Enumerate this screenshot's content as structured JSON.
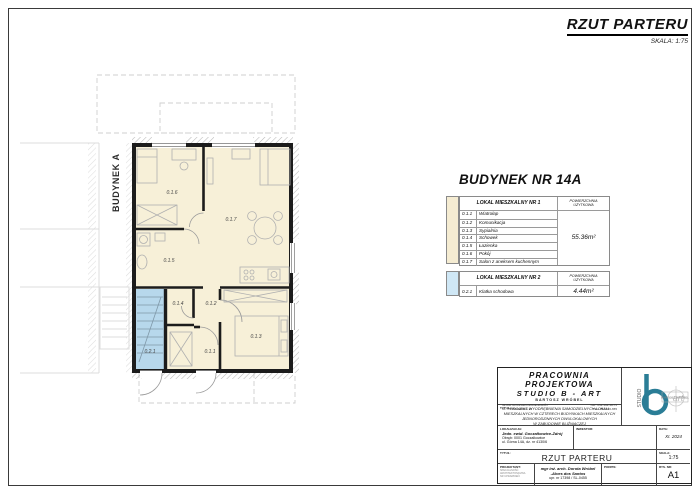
{
  "header": {
    "title": "RZUT PARTERU",
    "scale_note": "SKALA: 1:75"
  },
  "building_heading": "BUDYNEK NR 14A",
  "plan": {
    "neighbor_label": "BUDYNEK A",
    "colors": {
      "room_fill": "#f7f0d8",
      "stair_fill": "#b7d8ec",
      "wall": "#1c1c1c"
    },
    "rooms": [
      {
        "id": "0.1.6"
      },
      {
        "id": "0.1.7"
      },
      {
        "id": "0.1.5"
      },
      {
        "id": "0.1.4"
      },
      {
        "id": "0.1.2"
      },
      {
        "id": "0.2.1"
      },
      {
        "id": "0.1.1"
      },
      {
        "id": "0.1.3"
      }
    ]
  },
  "legend": {
    "table1": {
      "title": "LOKAL MIESZKALNY NR 1",
      "area_header": "POWIERZCHNIA\nUŻYTKOWA",
      "swatch_color": "#f5ecd2",
      "rows": [
        {
          "num": "0.1.1",
          "name": "Wiatrołap"
        },
        {
          "num": "0.1.2",
          "name": "Komunikacja"
        },
        {
          "num": "0.1.3",
          "name": "Sypialnia"
        },
        {
          "num": "0.1.4",
          "name": "Schowek"
        },
        {
          "num": "0.1.5",
          "name": "Łazienka"
        },
        {
          "num": "0.1.6",
          "name": "Pokój"
        },
        {
          "num": "0.1.7",
          "name": "Salon z aneksem kuchennym"
        }
      ],
      "area_total": "55.36m²"
    },
    "table2": {
      "title": "LOKAL MIESZKALNY NR 2",
      "area_header": "POWIERZCHNIA\nUŻYTKOWA",
      "swatch_color": "#cfe7f5",
      "rows": [
        {
          "num": "0.2.1",
          "name": "Klatka schodowa"
        }
      ],
      "area_total": "4.44m²"
    }
  },
  "titleblock": {
    "firm_line1": "PRACOWNIA PROJEKTOWA",
    "firm_line2": "STUDIO B - ART",
    "firm_line3": "BARTOSZ WRÓBEL",
    "address_line1": "43-230 GOCZAŁKOWICE-ZDRÓJ",
    "address_line2": "UL. POŁUDNIOWA 14",
    "nip": "NIP: 652-162-18-75",
    "tel": "TEL: 784-520-655",
    "temat_label": "TYTUŁ:",
    "temat_lines": [
      "PROJEKT WYODRĘBNIENIA SAMODZIELNYCH LOKALI",
      "MIESZKALNYCH W CZTERECH BUDYNKACH MIESZKALNYCH",
      "JEDNORODZINNYCH DWULOKALOWYCH",
      "W ZABUDOWIE BLIŹNIACZEJ"
    ],
    "lokalizacja_label": "LOKALIZACJA:",
    "lokalizacja_line1": "Jedn. ewid. Goczałkowice-Zdrój",
    "lokalizacja_line2": "Obręb: 0001 Goczałkowice",
    "lokalizacja_line3": "ul. Górna 14A, dz. nr 4130/6",
    "inwestor_label": "INWESTOR:",
    "data_label": "DATA:",
    "data_value": "XI. 2024",
    "tytul_label": "TYTUŁ:",
    "tytul_value": "RZUT PARTERU",
    "skala_label": "SKALA:",
    "skala_value": "1:75",
    "projektant_label": "PROJEKTANT:",
    "projektant_sub1": "SPECJALNOŚĆ:",
    "projektant_sub2": "ARCHITEKTONICZNA",
    "projektant_sub3": "NR UPRAWNIEŃ:",
    "projektant_name": "mgr inż. arch. Dorota Wróbel",
    "projektant_name2": "-Alves dos Santos",
    "projektant_upr": "upr. nr 17398 / SL-0455",
    "podpis_label": "PODPIS:",
    "rysnr_label": "RYS. NR:",
    "rysnr_value": "A1",
    "logo": {
      "studio": "STUDIO",
      "art": "art",
      "name": "BARTOSZ WRÓBEL",
      "teal": "#2a7d96"
    }
  }
}
